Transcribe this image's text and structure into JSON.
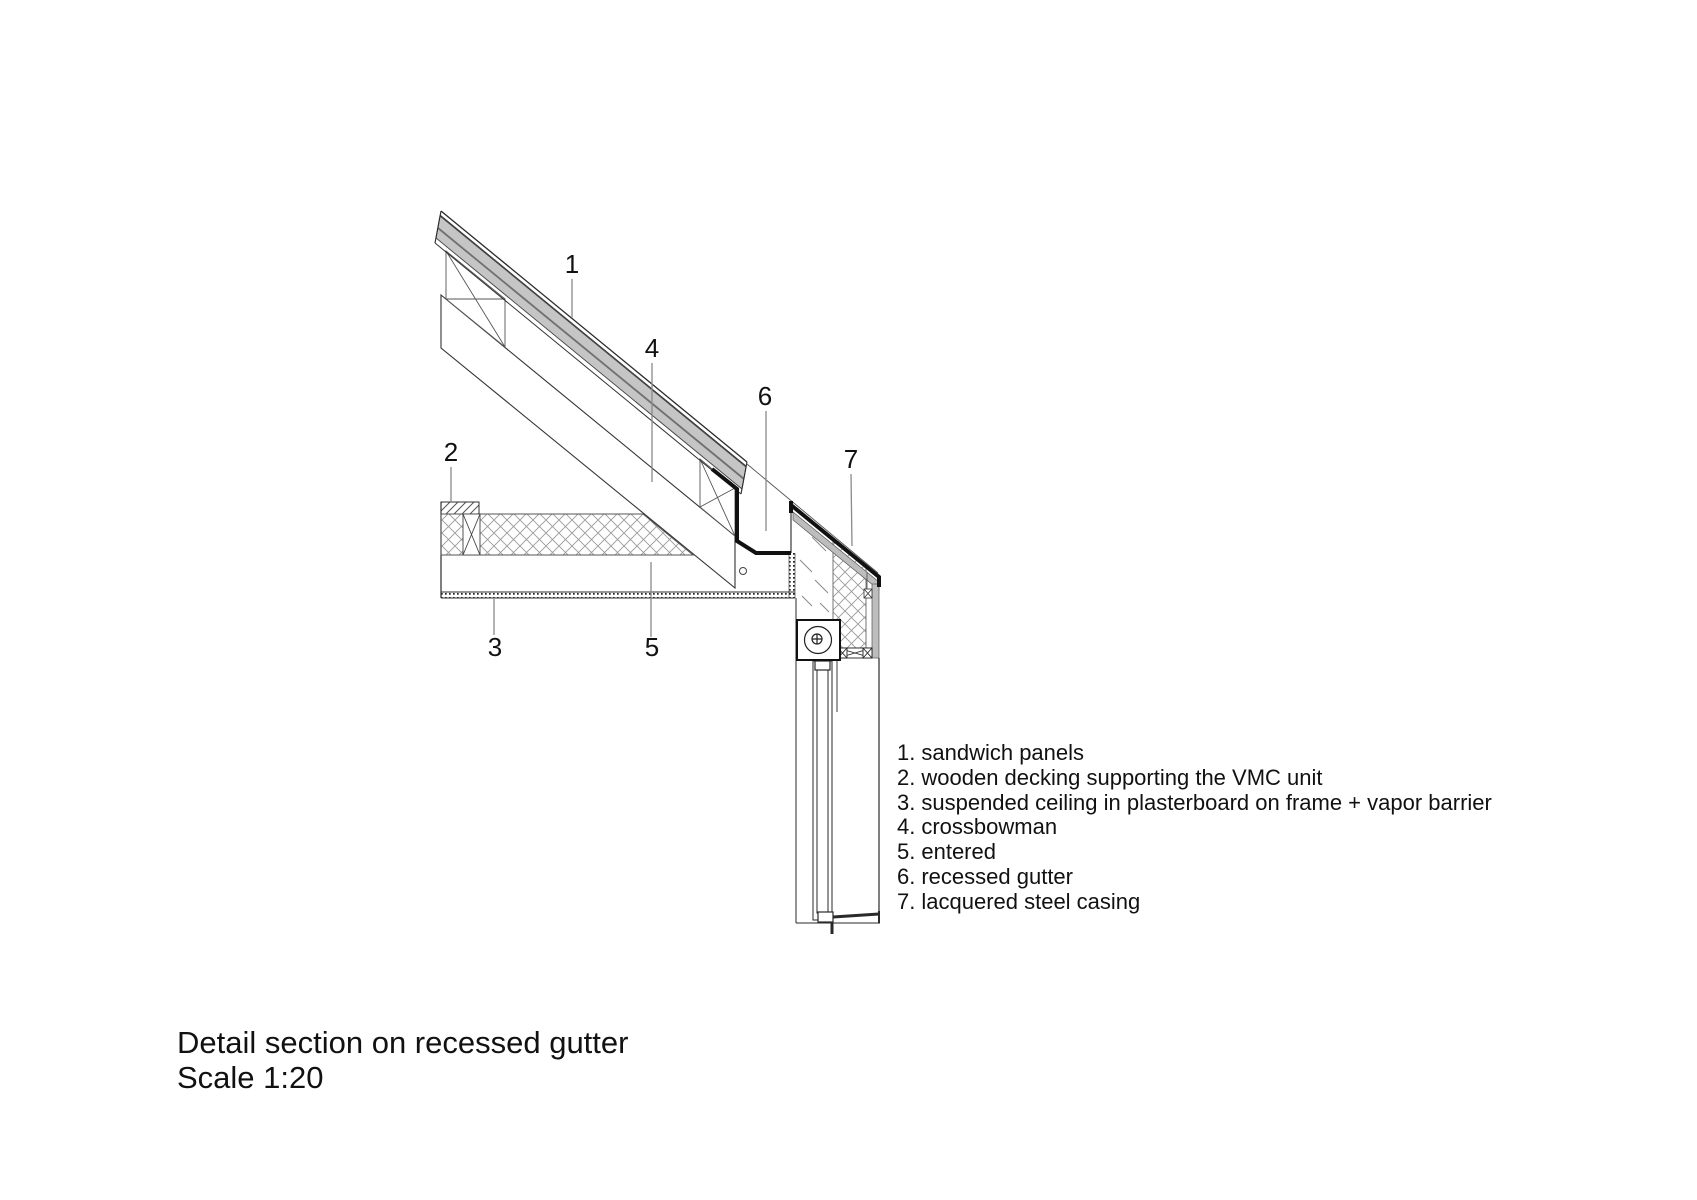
{
  "colors": {
    "line": "#2a2a2a",
    "panel-core": "#c5c5c5",
    "casing": "#bdbdbd",
    "hatch": "#9a9a9a",
    "leader": "#8a8a8a",
    "text": "#111111"
  },
  "drawing": {
    "callouts": [
      {
        "number": "1"
      },
      {
        "number": "2"
      },
      {
        "number": "3"
      },
      {
        "number": "4"
      },
      {
        "number": "5"
      },
      {
        "number": "6"
      },
      {
        "number": "7"
      }
    ]
  },
  "legend": {
    "items": [
      {
        "num": "1.",
        "label": "sandwich panels"
      },
      {
        "num": "2.",
        "label": "wooden decking supporting the VMC unit"
      },
      {
        "num": "3.",
        "label": "suspended ceiling in plasterboard on frame + vapor barrier"
      },
      {
        "num": "4.",
        "label": "crossbowman"
      },
      {
        "num": "5.",
        "label": "entered"
      },
      {
        "num": "6.",
        "label": "recessed gutter"
      },
      {
        "num": "7.",
        "label": "lacquered steel casing"
      }
    ]
  },
  "title": {
    "line1": "Detail section on recessed gutter",
    "line2": "Scale 1:20"
  }
}
